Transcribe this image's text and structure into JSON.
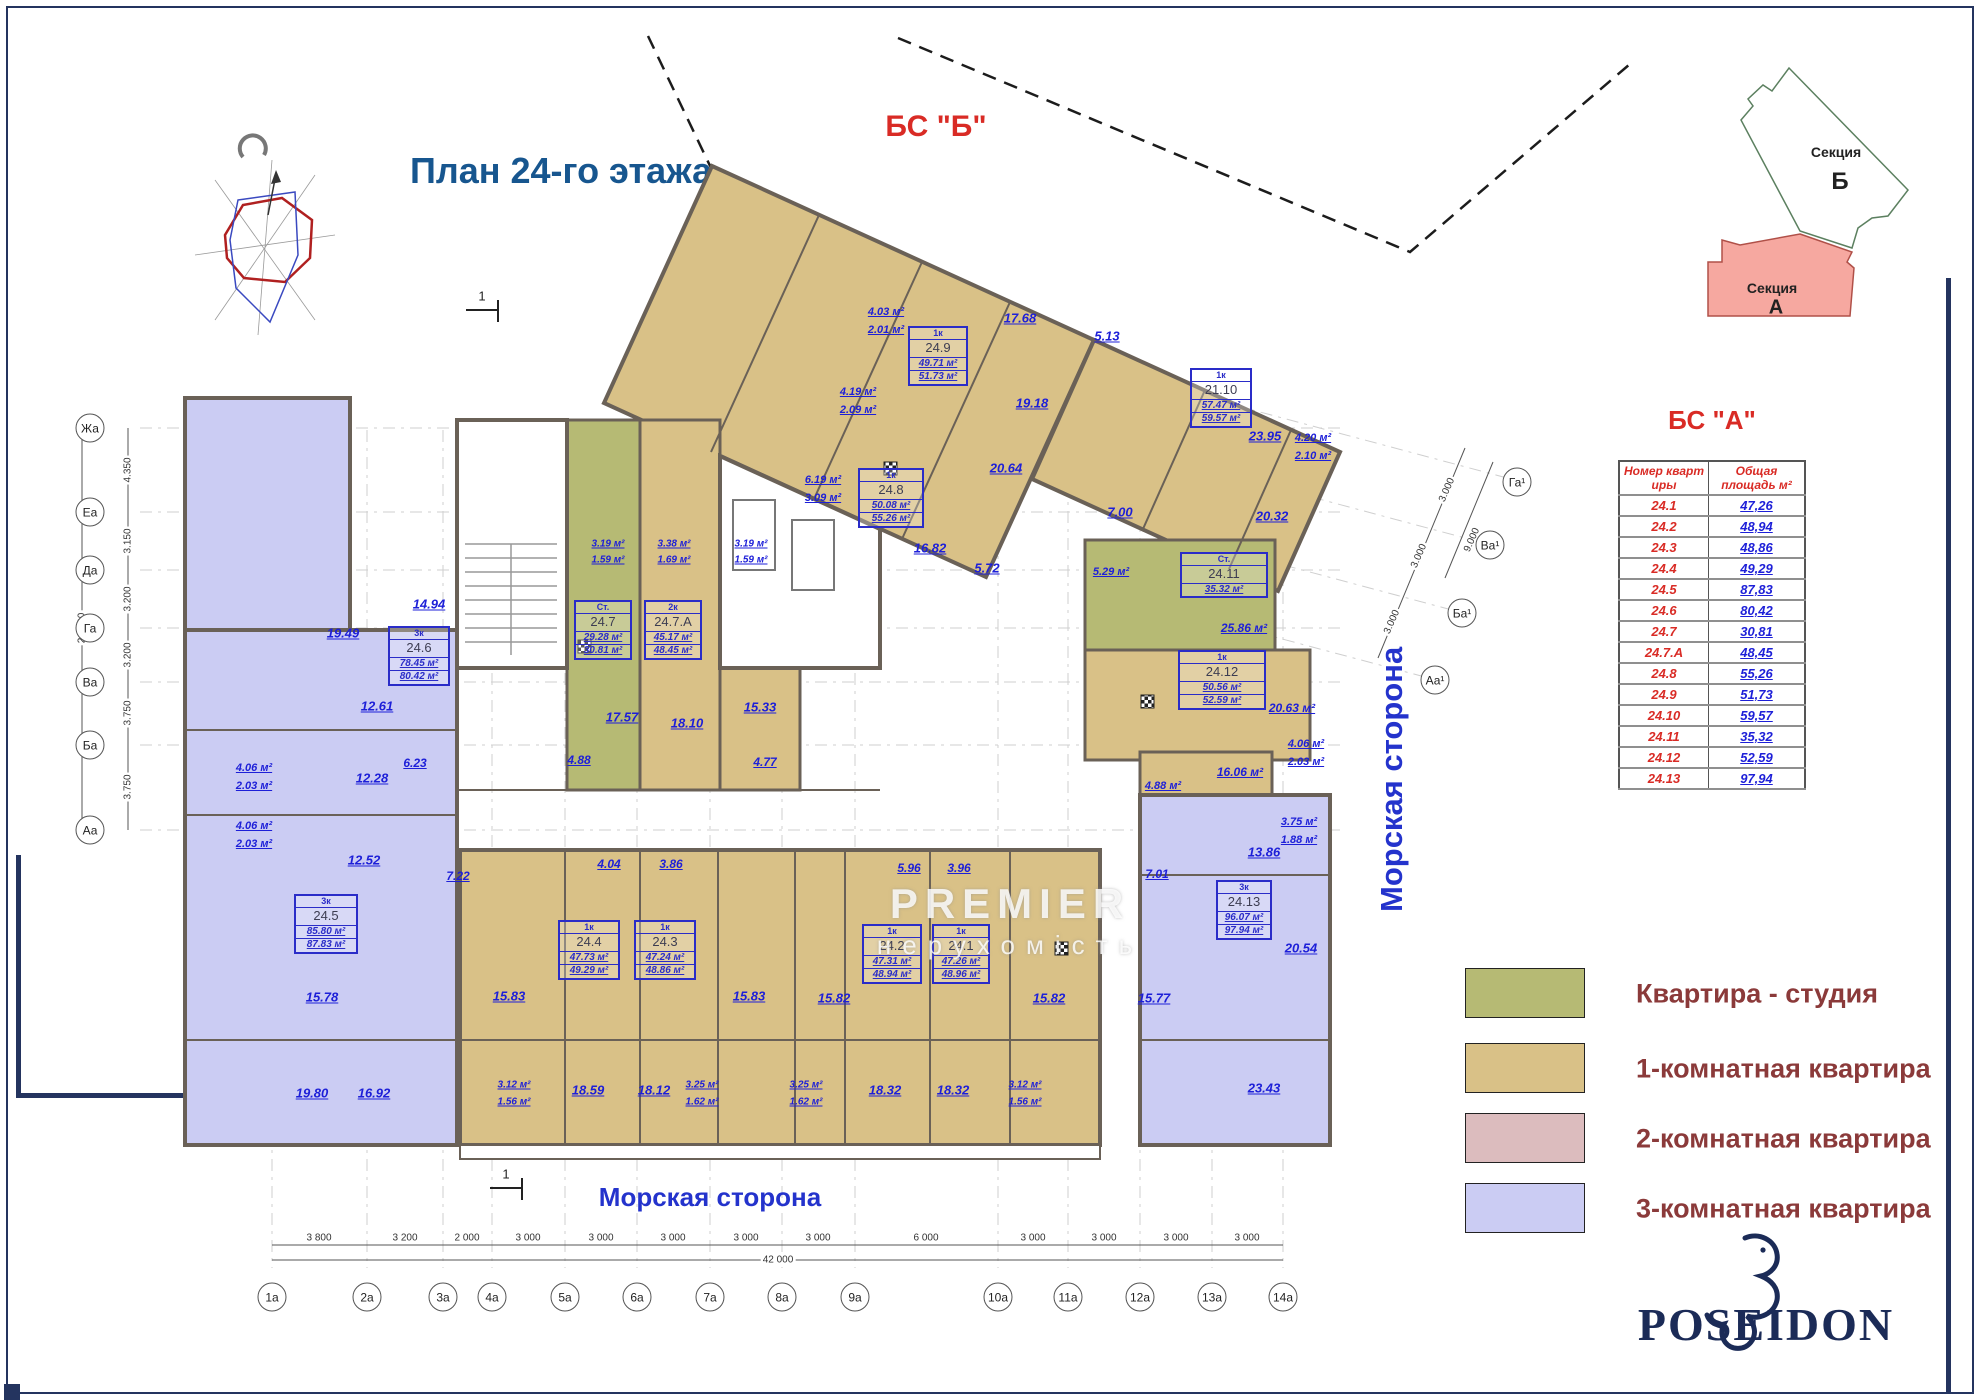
{
  "header": {
    "title": "План 24-го этажа",
    "bs_b": "БС \"Б\"",
    "bs_a": "БС \"А\""
  },
  "inset": {
    "section_word": "Секция",
    "b": "Б",
    "a": "А"
  },
  "table": {
    "col1": "Номер кварт иры",
    "col2": "Общая площадь м²",
    "rows": [
      {
        "n": "24.1",
        "a": "47,26"
      },
      {
        "n": "24.2",
        "a": "48,94"
      },
      {
        "n": "24.3",
        "a": "48,86"
      },
      {
        "n": "24.4",
        "a": "49,29"
      },
      {
        "n": "24.5",
        "a": "87,83"
      },
      {
        "n": "24.6",
        "a": "80,42"
      },
      {
        "n": "24.7",
        "a": "30,81"
      },
      {
        "n": "24.7.А",
        "a": "48,45"
      },
      {
        "n": "24.8",
        "a": "55,26"
      },
      {
        "n": "24.9",
        "a": "51,73"
      },
      {
        "n": "24.10",
        "a": "59,57"
      },
      {
        "n": "24.11",
        "a": "35,32"
      },
      {
        "n": "24.12",
        "a": "52,59"
      },
      {
        "n": "24.13",
        "a": "97,94"
      }
    ]
  },
  "legend": {
    "items": [
      {
        "label": "Квартира - студия",
        "color": "#b6ba74"
      },
      {
        "label": "1-комнатная квартира",
        "color": "#d9c187"
      },
      {
        "label": "2-комнатная квартира",
        "color": "#dcbcbe"
      },
      {
        "label": "3-комнатная квартира",
        "color": "#cbccf3"
      }
    ]
  },
  "sides": {
    "right": "Морская сторона",
    "bottom": "Морская сторона"
  },
  "axes": {
    "left": [
      "Жа",
      "Еа",
      "Да",
      "Га",
      "Ва",
      "Ба",
      "Аа"
    ],
    "bottom": [
      "1а",
      "2а",
      "3а",
      "4а",
      "5а",
      "6а",
      "7а",
      "8а",
      "9а",
      "10а",
      "11а",
      "12а",
      "13а",
      "14а"
    ],
    "right": [
      "Га¹",
      "Ва¹",
      "Ба¹",
      "Аа¹"
    ],
    "dims_bottom": [
      "3 800",
      "3 200",
      "2 000",
      "3 000",
      "3 000",
      "3 000",
      "3 000",
      "3 000",
      "6 000",
      "3 000",
      "3 000",
      "3 000",
      "3 000"
    ],
    "total_bottom": "42 000",
    "dims_left": [
      "4.350",
      "3.150",
      "3.200",
      "3.200",
      "3.750",
      "3.750"
    ],
    "total_left": "21.400",
    "dims_right": [
      "3.000",
      "3.000",
      "3.000",
      "9.000"
    ],
    "section_mark": "1"
  },
  "units": [
    {
      "t": "1к",
      "n": "24.9",
      "a1": "49.71 м²",
      "a2": "51.73 м²"
    },
    {
      "t": "1к",
      "n": "24.8",
      "a1": "50.08 м²",
      "a2": "55.26 м²"
    },
    {
      "t": "1к",
      "n": "21.10",
      "a1": "57.47 м²",
      "a2": "59.57 м²"
    },
    {
      "t": "Ст.",
      "n": "24.11",
      "a1": "35.32 м²",
      "a2": ""
    },
    {
      "t": "1к",
      "n": "24.12",
      "a1": "50.56 м²",
      "a2": "52.59 м²"
    },
    {
      "t": "3к",
      "n": "24.13",
      "a1": "96.07 м²",
      "a2": "97.94 м²"
    },
    {
      "t": "Ст.",
      "n": "24.7",
      "a1": "29.28 м²",
      "a2": "30.81 м²"
    },
    {
      "t": "2к",
      "n": "24.7.А",
      "a1": "45.17 м²",
      "a2": "48.45 м²"
    },
    {
      "t": "3к",
      "n": "24.6",
      "a1": "78.45 м²",
      "a2": "80.42 м²"
    },
    {
      "t": "3к",
      "n": "24.5",
      "a1": "85.80 м²",
      "a2": "87.83 м²"
    },
    {
      "t": "1к",
      "n": "24.4",
      "a1": "47.73 м²",
      "a2": "49.29 м²"
    },
    {
      "t": "1к",
      "n": "24.3",
      "a1": "47.24 м²",
      "a2": "48.86 м²"
    },
    {
      "t": "1к",
      "n": "24.2",
      "a1": "47.31 м²",
      "a2": "48.94 м²"
    },
    {
      "t": "1к",
      "n": "24.1",
      "a1": "47.26 м²",
      "a2": "48.96 м²"
    }
  ],
  "rooms": [
    "4.03 м²",
    "2.01 м²",
    "17.68",
    "4.19 м²",
    "2.09 м²",
    "19.18",
    "20.64",
    "5.13",
    "6.19 м²",
    "3.09 м²",
    "23.95",
    "4.20 м²",
    "2.10 м²",
    "20.32",
    "7.00",
    "16.82",
    "5.72",
    "5.29 м²",
    "25.86 м²",
    "20.63 м²",
    "16.06 м²",
    "4.88 м²",
    "4.06 м²",
    "2.03 м²",
    "13.86",
    "3.75 м²",
    "1.88 м²",
    "20.54",
    "15.77",
    "23.43",
    "7.01",
    "19.49",
    "14.94",
    "12.61",
    "12.28",
    "6.23",
    "4.06 м²",
    "2.03 м²",
    "4.06 м²",
    "2.03 м²",
    "12.52",
    "15.78",
    "19.80",
    "16.92",
    "7.22",
    "3.19 м²",
    "1.59 м²",
    "3.38 м²",
    "1.69 м²",
    "3.19 м²",
    "1.59 м²",
    "17.57",
    "4.88",
    "18.10",
    "15.33",
    "4.77",
    "4.04",
    "3.86",
    "5.96",
    "3.96",
    "15.83",
    "15.83",
    "15.82",
    "15.82",
    "3.12 м²",
    "1.56 м²",
    "18.59",
    "18.12",
    "3.25 м²",
    "1.62 м²",
    "3.25 м²",
    "1.62 м²",
    "18.32",
    "18.32",
    "3.12 м²",
    "1.56 м²"
  ],
  "watermark": {
    "line1": "PREMIER",
    "line2": "нерухомість"
  },
  "logo": {
    "text": "POSEIDON"
  }
}
